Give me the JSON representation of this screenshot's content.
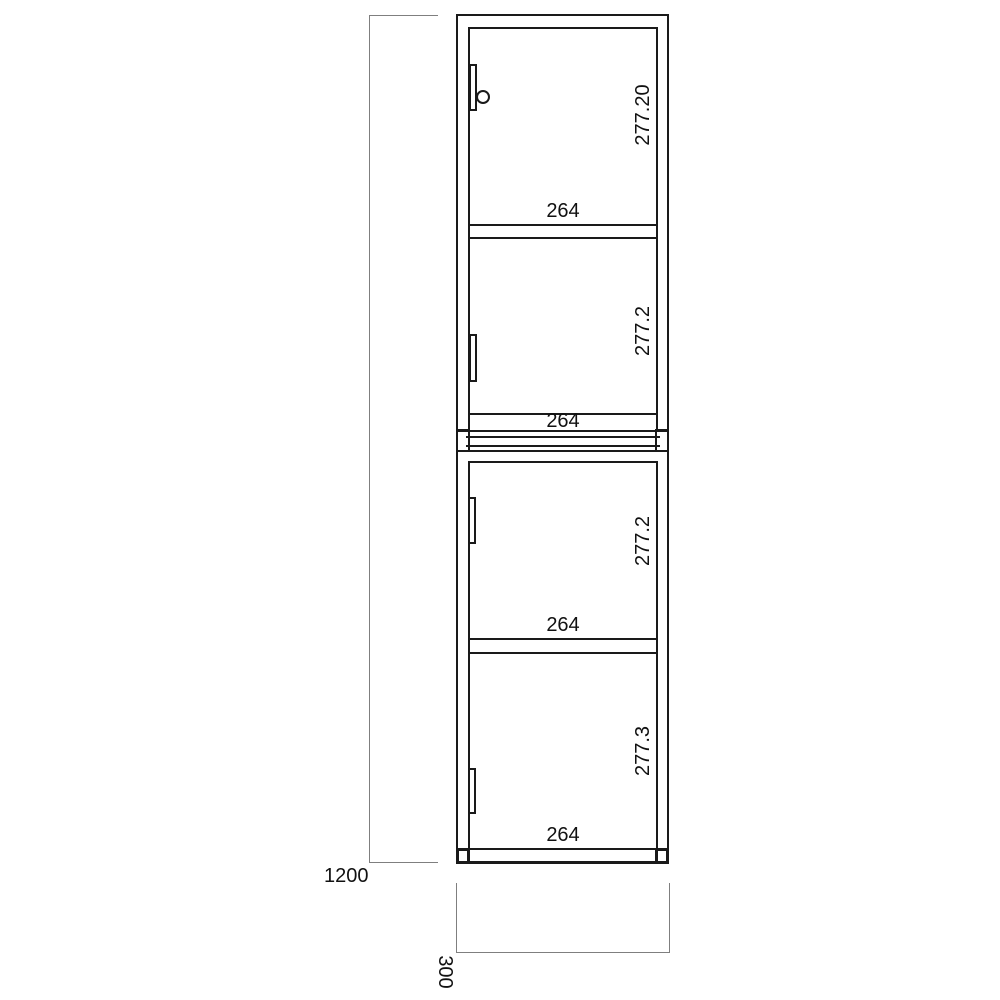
{
  "drawing": {
    "kind": "cabinet-front-elevation",
    "overall_height_label": "1200",
    "depth_label": "300",
    "sections": [
      {
        "width_label": "264",
        "height_label": "277.20"
      },
      {
        "width_label": "264",
        "height_label": "277.2"
      },
      {
        "width_label": "264",
        "height_label": "277.2"
      },
      {
        "width_label": "264",
        "height_label": "277.3"
      }
    ],
    "colors": {
      "line": "#1a1a1a",
      "dimension_line": "#7f7f7f",
      "background": "#ffffff",
      "text": "#111111"
    }
  }
}
